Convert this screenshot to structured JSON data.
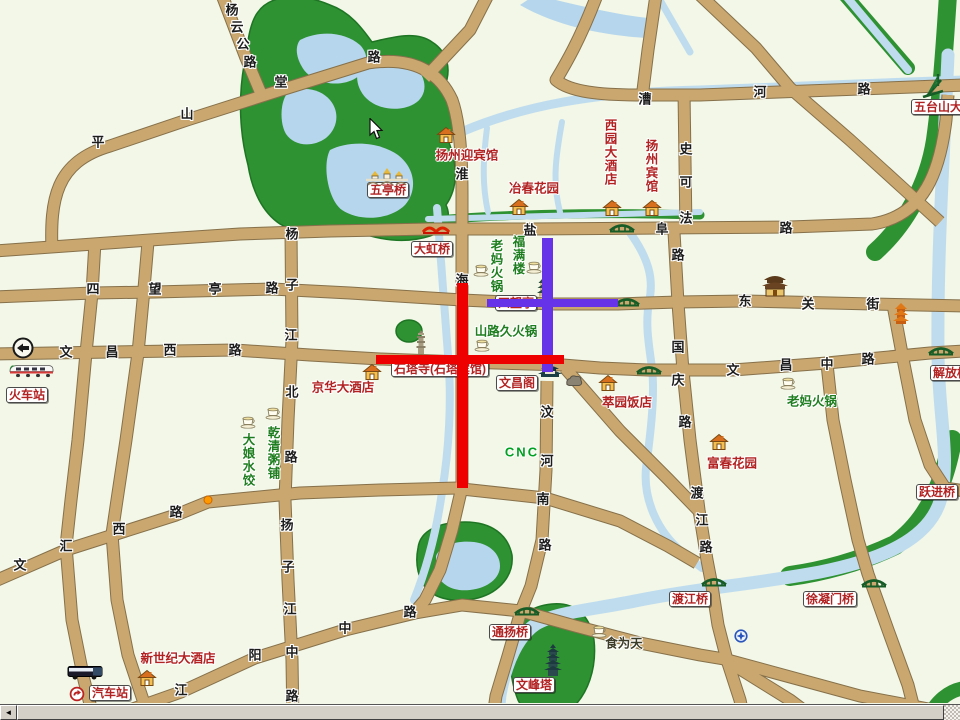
{
  "map": {
    "colors": {
      "background": "#f2f7e7",
      "road": "#c9a76f",
      "road_edge": "#86704a",
      "water": "#bfdcef",
      "park": "#2e9132",
      "route_red": "#ee0000",
      "route_purple": "#6633e8",
      "poi_red": "#b22222",
      "poi_green": "#1e7d1e"
    },
    "road_labels": [
      {
        "t": "平",
        "x": 98,
        "y": 141
      },
      {
        "t": "山",
        "x": 187,
        "y": 113
      },
      {
        "t": "堂",
        "x": 281,
        "y": 81
      },
      {
        "t": "路",
        "x": 374,
        "y": 56
      },
      {
        "t": "杨",
        "x": 232,
        "y": 9
      },
      {
        "t": "云",
        "x": 237,
        "y": 26
      },
      {
        "t": "公",
        "x": 243,
        "y": 43
      },
      {
        "t": "路",
        "x": 250,
        "y": 61
      },
      {
        "t": "淮",
        "x": 462,
        "y": 173
      },
      {
        "t": "海",
        "x": 462,
        "y": 279
      },
      {
        "t": "盐",
        "x": 530,
        "y": 229
      },
      {
        "t": "阜",
        "x": 662,
        "y": 228
      },
      {
        "t": "路",
        "x": 786,
        "y": 227
      },
      {
        "t": "漕",
        "x": 645,
        "y": 98
      },
      {
        "t": "河",
        "x": 760,
        "y": 91
      },
      {
        "t": "路",
        "x": 864,
        "y": 88
      },
      {
        "t": "史",
        "x": 686,
        "y": 148
      },
      {
        "t": "可",
        "x": 686,
        "y": 181
      },
      {
        "t": "法",
        "x": 686,
        "y": 217
      },
      {
        "t": "四",
        "x": 93,
        "y": 288
      },
      {
        "t": "望",
        "x": 155,
        "y": 288
      },
      {
        "t": "亭",
        "x": 215,
        "y": 288
      },
      {
        "t": "路",
        "x": 272,
        "y": 287
      },
      {
        "t": "杨",
        "x": 292,
        "y": 233
      },
      {
        "t": "子",
        "x": 292,
        "y": 284
      },
      {
        "t": "江",
        "x": 291,
        "y": 334
      },
      {
        "t": "北",
        "x": 292,
        "y": 391
      },
      {
        "t": "路",
        "x": 291,
        "y": 456
      },
      {
        "t": "文",
        "x": 66,
        "y": 351
      },
      {
        "t": "昌",
        "x": 112,
        "y": 351
      },
      {
        "t": "西",
        "x": 170,
        "y": 349
      },
      {
        "t": "路",
        "x": 235,
        "y": 349
      },
      {
        "t": "东",
        "x": 745,
        "y": 300
      },
      {
        "t": "关",
        "x": 808,
        "y": 303
      },
      {
        "t": "街",
        "x": 873,
        "y": 303
      },
      {
        "t": "路",
        "x": 678,
        "y": 254
      },
      {
        "t": "国",
        "x": 678,
        "y": 346
      },
      {
        "t": "庆",
        "x": 678,
        "y": 379
      },
      {
        "t": "路",
        "x": 685,
        "y": 421
      },
      {
        "t": "文",
        "x": 733,
        "y": 369
      },
      {
        "t": "昌",
        "x": 786,
        "y": 364
      },
      {
        "t": "中",
        "x": 827,
        "y": 363
      },
      {
        "t": "路",
        "x": 868,
        "y": 358
      },
      {
        "t": "汶",
        "x": 547,
        "y": 411
      },
      {
        "t": "河",
        "x": 547,
        "y": 460
      },
      {
        "t": "南",
        "x": 543,
        "y": 498
      },
      {
        "t": "路",
        "x": 545,
        "y": 544
      },
      {
        "t": "渡",
        "x": 697,
        "y": 492
      },
      {
        "t": "江",
        "x": 702,
        "y": 519
      },
      {
        "t": "路",
        "x": 706,
        "y": 546
      },
      {
        "t": "文",
        "x": 20,
        "y": 564
      },
      {
        "t": "汇",
        "x": 66,
        "y": 545
      },
      {
        "t": "西",
        "x": 119,
        "y": 528
      },
      {
        "t": "路",
        "x": 176,
        "y": 511
      },
      {
        "t": "江",
        "x": 181,
        "y": 689
      },
      {
        "t": "阳",
        "x": 255,
        "y": 654
      },
      {
        "t": "中",
        "x": 345,
        "y": 627
      },
      {
        "t": "路",
        "x": 410,
        "y": 611
      },
      {
        "t": "扬",
        "x": 287,
        "y": 524
      },
      {
        "t": "子",
        "x": 288,
        "y": 566
      },
      {
        "t": "江",
        "x": 290,
        "y": 608
      },
      {
        "t": "中",
        "x": 292,
        "y": 651
      },
      {
        "t": "路",
        "x": 292,
        "y": 695
      }
    ],
    "poi_boxes": [
      {
        "t": "五亭桥",
        "x": 388,
        "y": 190
      },
      {
        "t": "大虹桥",
        "x": 432,
        "y": 249
      },
      {
        "t": "四望亭",
        "x": 516,
        "y": 303
      },
      {
        "t": "石塔寺(石塔宾馆)",
        "x": 440,
        "y": 369
      },
      {
        "t": "文昌阁",
        "x": 517,
        "y": 383
      },
      {
        "t": "火车站",
        "x": 27,
        "y": 395
      },
      {
        "t": "汽车站",
        "x": 110,
        "y": 693
      },
      {
        "t": "通扬桥",
        "x": 510,
        "y": 632
      },
      {
        "t": "文峰塔",
        "x": 534,
        "y": 685
      },
      {
        "t": "渡江桥",
        "x": 690,
        "y": 599
      },
      {
        "t": "徐凝门桥",
        "x": 830,
        "y": 599
      },
      {
        "t": "跃进桥",
        "x": 937,
        "y": 492
      },
      {
        "t": "解放桥",
        "x": 951,
        "y": 373
      },
      {
        "t": "五台山大桥",
        "x": 944,
        "y": 107
      }
    ],
    "poi_texts": [
      {
        "t": "扬州迎宾馆",
        "x": 467,
        "y": 154,
        "c": "red"
      },
      {
        "t": "冶春花园",
        "x": 534,
        "y": 187,
        "c": "red"
      },
      {
        "t": "西园大酒店",
        "x": 610,
        "y": 152,
        "c": "red",
        "vert": true
      },
      {
        "t": "扬州宾馆",
        "x": 651,
        "y": 166,
        "c": "red",
        "vert": true
      },
      {
        "t": "京华大酒店",
        "x": 343,
        "y": 386,
        "c": "red"
      },
      {
        "t": "萃园饭店",
        "x": 627,
        "y": 401,
        "c": "red"
      },
      {
        "t": "富春花园",
        "x": 732,
        "y": 462,
        "c": "red"
      },
      {
        "t": "新世纪大酒店",
        "x": 178,
        "y": 657,
        "c": "red"
      },
      {
        "t": "老妈火锅",
        "x": 496,
        "y": 266,
        "c": "green",
        "vert": true
      },
      {
        "t": "福满楼",
        "x": 518,
        "y": 255,
        "c": "green",
        "vert": true
      },
      {
        "t": "山路久火锅",
        "x": 506,
        "y": 330,
        "c": "green"
      },
      {
        "t": "老妈火锅",
        "x": 812,
        "y": 400,
        "c": "green"
      },
      {
        "t": "大娘水饺",
        "x": 248,
        "y": 460,
        "c": "green",
        "vert": true
      },
      {
        "t": "乾清粥铺",
        "x": 273,
        "y": 453,
        "c": "green",
        "vert": true
      },
      {
        "t": "CNC",
        "x": 522,
        "y": 452,
        "c": "cnc"
      },
      {
        "t": "食为天",
        "x": 624,
        "y": 642,
        "c": "dark"
      }
    ],
    "icons": [
      {
        "type": "five-bridge",
        "x": 387,
        "y": 176
      },
      {
        "type": "house",
        "x": 446,
        "y": 135
      },
      {
        "type": "house",
        "x": 519,
        "y": 207
      },
      {
        "type": "house",
        "x": 612,
        "y": 208
      },
      {
        "type": "house",
        "x": 652,
        "y": 208
      },
      {
        "type": "house",
        "x": 372,
        "y": 372
      },
      {
        "type": "house",
        "x": 608,
        "y": 383
      },
      {
        "type": "house",
        "x": 719,
        "y": 442
      },
      {
        "type": "house",
        "x": 147,
        "y": 678
      },
      {
        "type": "temple",
        "x": 775,
        "y": 284
      },
      {
        "type": "orange-pagoda",
        "x": 901,
        "y": 313
      },
      {
        "type": "pavilion-dark",
        "x": 550,
        "y": 369
      },
      {
        "type": "rock",
        "x": 574,
        "y": 380
      },
      {
        "type": "tower",
        "x": 543,
        "y": 287
      },
      {
        "type": "stone-pagoda",
        "x": 421,
        "y": 342
      },
      {
        "type": "big-pagoda",
        "x": 553,
        "y": 660
      },
      {
        "type": "bridge-red",
        "x": 436,
        "y": 228
      },
      {
        "type": "bridge-green",
        "x": 622,
        "y": 226
      },
      {
        "type": "bridge-green",
        "x": 627,
        "y": 300
      },
      {
        "type": "bridge-green",
        "x": 649,
        "y": 368
      },
      {
        "type": "bridge-green",
        "x": 941,
        "y": 349
      },
      {
        "type": "bridge-green",
        "x": 714,
        "y": 580
      },
      {
        "type": "bridge-green",
        "x": 874,
        "y": 581
      },
      {
        "type": "bridge-green",
        "x": 527,
        "y": 609
      },
      {
        "type": "bridge-cable",
        "x": 933,
        "y": 85
      },
      {
        "type": "cup",
        "x": 481,
        "y": 270
      },
      {
        "type": "cup",
        "x": 534,
        "y": 267
      },
      {
        "type": "cup",
        "x": 482,
        "y": 345
      },
      {
        "type": "cup",
        "x": 788,
        "y": 383
      },
      {
        "type": "cup",
        "x": 248,
        "y": 422
      },
      {
        "type": "cup",
        "x": 273,
        "y": 413
      },
      {
        "type": "cup",
        "x": 599,
        "y": 631
      },
      {
        "type": "train",
        "x": 31,
        "y": 370
      },
      {
        "type": "bus",
        "x": 85,
        "y": 672
      },
      {
        "type": "bus-logo",
        "x": 77,
        "y": 694
      },
      {
        "type": "back-arrow",
        "x": 23,
        "y": 348
      },
      {
        "type": "blue-cross",
        "x": 741,
        "y": 636
      },
      {
        "type": "orange-dot",
        "x": 208,
        "y": 500
      },
      {
        "type": "cursor",
        "x": 376,
        "y": 129
      }
    ],
    "routes": [
      {
        "id": "route-purple-vertical",
        "color": "#6633e8",
        "x": 542,
        "y": 238,
        "w": 11,
        "h": 134
      },
      {
        "id": "route-purple-horizontal",
        "color": "#6633e8",
        "x": 487,
        "y": 299,
        "w": 131,
        "h": 8
      },
      {
        "id": "route-red-vertical",
        "color": "#ee0000",
        "x": 457,
        "y": 283,
        "w": 11,
        "h": 205
      },
      {
        "id": "route-red-horizontal",
        "color": "#ee0000",
        "x": 376,
        "y": 355,
        "w": 188,
        "h": 9
      }
    ]
  },
  "scrollbar": {
    "left_arrow": "◄"
  }
}
